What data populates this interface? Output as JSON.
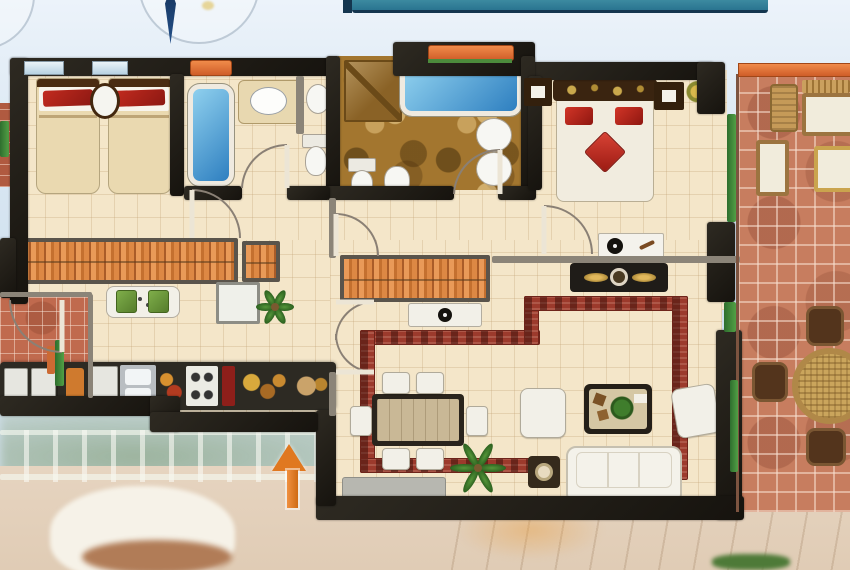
{
  "meta": {
    "image_type": "apartment-floor-plan-composite",
    "text_visible": false
  },
  "colors": {
    "sky": "#dfe9f4",
    "banner_teal": "#2f7f95",
    "banner_navy": "#14364f",
    "needle_navy": "#1d3c6b",
    "wall": "#211e19",
    "wall_light": "#8b8478",
    "floor_cream": "#f4e6c9",
    "marble": "#a3762f",
    "terracotta": "#c77d5f",
    "laundry_tile": "#c06a4e",
    "accent_orange": "#e2703a",
    "window_green": "#3e8a3e",
    "inlay_red": "#9c3a2c",
    "wardrobe_orange": "#d98a48",
    "bed_red": "#c22018",
    "arrow_orange": "#e07820",
    "sofa_white": "#f3f1e9",
    "counter_dark": "#2d2a23",
    "gold": "#c69a3c"
  },
  "indicators": {
    "compass_needle": "north-needle",
    "entrance_arrow_direction": "up",
    "header_banner": "teal-strip-cropped"
  },
  "rooms": [
    {
      "name": "twin-bedroom",
      "furniture": [
        "single-bed",
        "single-bed",
        "wall-mirror"
      ]
    },
    {
      "name": "second-bathroom",
      "furniture": [
        "bathtub",
        "washbasin-cabinet",
        "pedestal-sink",
        "toilet"
      ]
    },
    {
      "name": "main-bathroom",
      "furniture": [
        "bathtub",
        "corner-shower",
        "round-basin",
        "round-basin",
        "toilet",
        "bidet"
      ]
    },
    {
      "name": "master-bedroom",
      "furniture": [
        "double-bed",
        "bedside-niche",
        "wall-picture",
        "gold-plant",
        "shelf-with-tv",
        "dresser"
      ]
    },
    {
      "name": "hallway",
      "furniture": [
        "wardrobe-long",
        "wardrobe-short",
        "wardrobe-second",
        "console-table"
      ]
    },
    {
      "name": "kitchen",
      "furniture": [
        "counter-sink-hob",
        "washing-machines",
        "breakfast-table",
        "green-chair",
        "green-chair",
        "fridge",
        "palm-plant"
      ]
    },
    {
      "name": "utility-room",
      "furniture": []
    },
    {
      "name": "dining-area",
      "furniture": [
        "dining-table",
        "chair",
        "chair",
        "chair",
        "chair",
        "chair",
        "chair",
        "sideboard",
        "palm-plant"
      ]
    },
    {
      "name": "living-room",
      "furniture": [
        "three-seat-sofa",
        "armchair",
        "armchair",
        "coffee-table",
        "lamp-side-table",
        "red-floor-inlay"
      ]
    },
    {
      "name": "terrace",
      "furniture": [
        "wicker-chair",
        "slatted-bench",
        "lounger",
        "lounger",
        "lounger",
        "round-wicker-table",
        "terrace-chair",
        "terrace-chair",
        "terrace-chair"
      ]
    }
  ]
}
